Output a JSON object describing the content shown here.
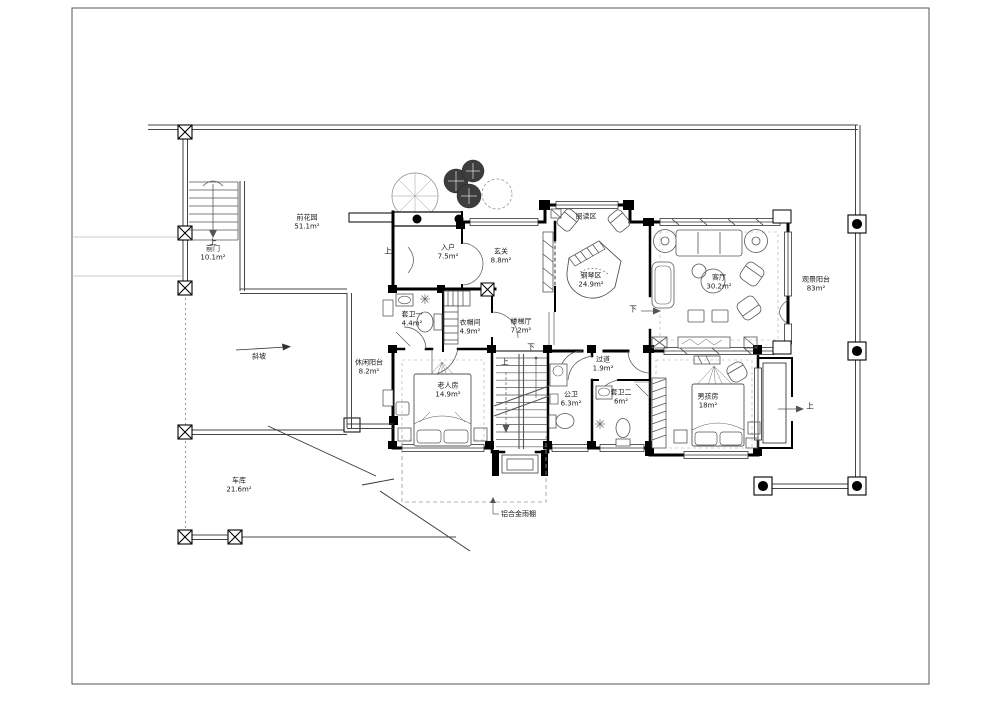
{
  "plan": {
    "rooms": {
      "front_garden": {
        "label": "前花园",
        "area": "51.1m²"
      },
      "front_gate": {
        "label": "前门",
        "area": "10.1m²"
      },
      "entry": {
        "label": "入户",
        "area": "7.5m²"
      },
      "foyer": {
        "label": "玄关",
        "area": "8.8m²"
      },
      "reading_area": {
        "label": "阅读区",
        "area": ""
      },
      "piano_area": {
        "label": "钢琴区",
        "area": "24.9m²"
      },
      "living_room": {
        "label": "客厅",
        "area": "30.2m²"
      },
      "view_balcony": {
        "label": "观景阳台",
        "area": "83m²"
      },
      "ensuite_bath_1": {
        "label": "套卫一",
        "area": "4.4m²"
      },
      "cloakroom": {
        "label": "衣帽间",
        "area": "4.9m²"
      },
      "stair_hall": {
        "label": "楼梯厅",
        "area": "7.2m²"
      },
      "leisure_balcony": {
        "label": "休闲阳台",
        "area": "8.2m²"
      },
      "elder_room": {
        "label": "老人房",
        "area": "14.9m²"
      },
      "public_bath": {
        "label": "公卫",
        "area": "6.3m²"
      },
      "corridor": {
        "label": "过道",
        "area": "1.9m²"
      },
      "ensuite_bath_2": {
        "label": "套卫二",
        "area": "6m²"
      },
      "boys_room": {
        "label": "男孩房",
        "area": "18m²"
      },
      "garage": {
        "label": "车库",
        "area": "21.6m²"
      }
    },
    "marks": {
      "up": "上",
      "down": "下"
    },
    "annotations": {
      "slope": "斜坡",
      "canopy": "铝合金雨棚"
    }
  }
}
